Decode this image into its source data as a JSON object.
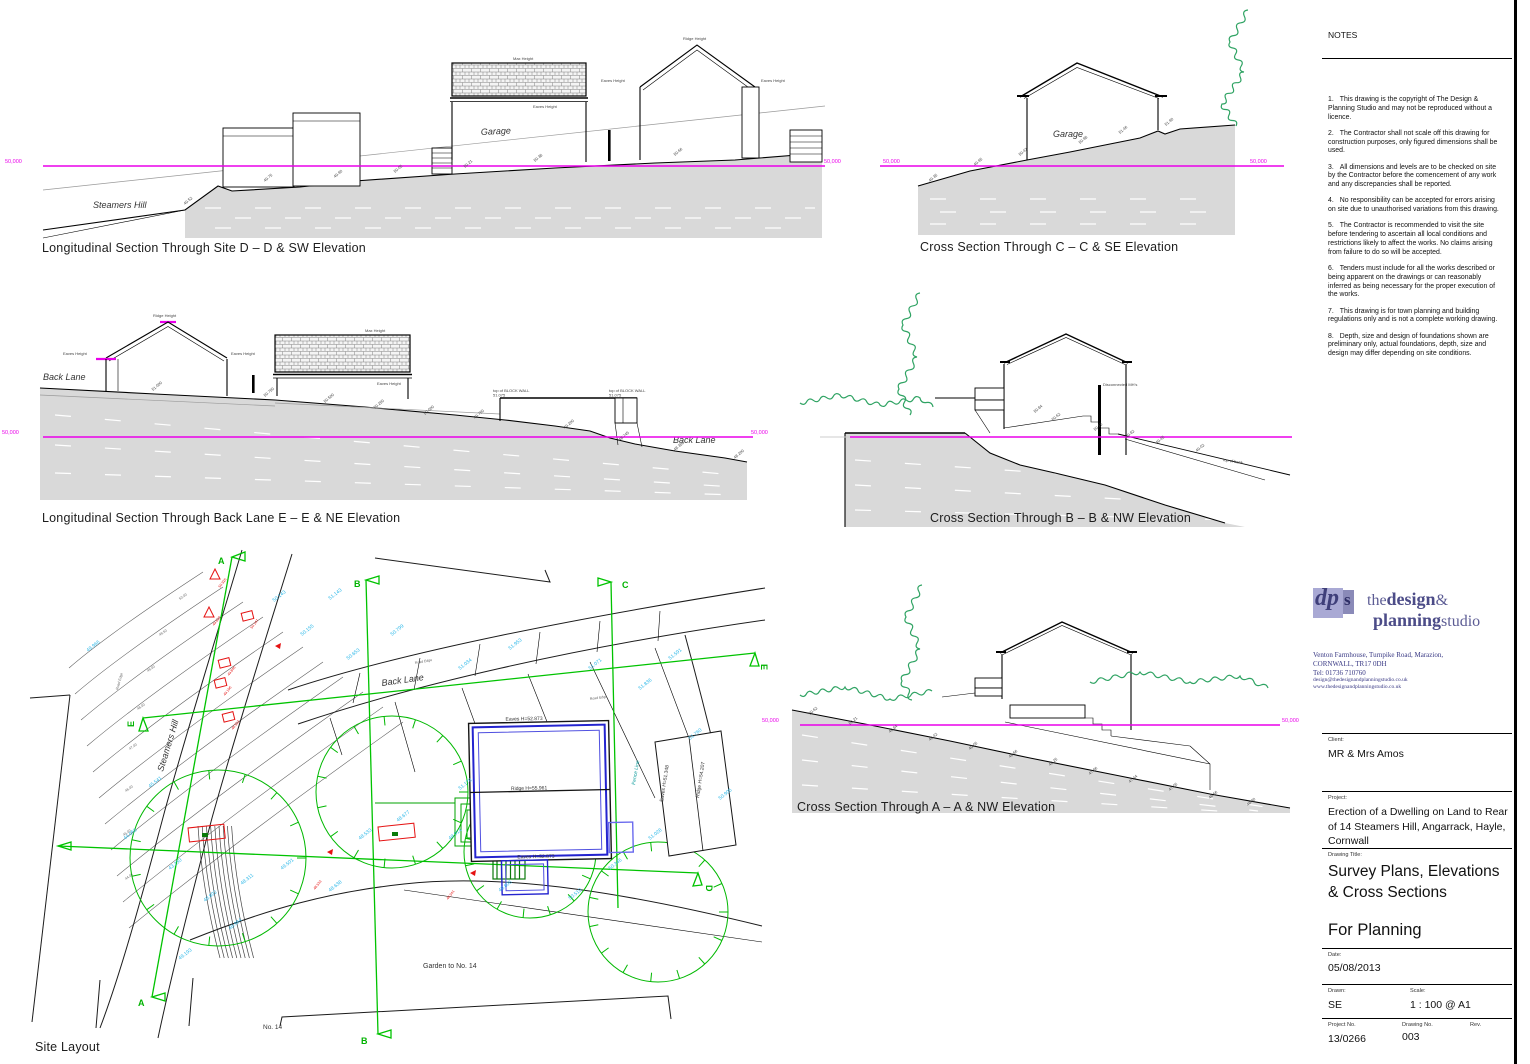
{
  "generic": {
    "ridge": "Ridge Height",
    "eaves": "Eaves Height",
    "max": "Max Height"
  },
  "sections": {
    "dd": {
      "caption": "Longitudinal Section Through Site D – D & SW Elevation",
      "road": "Steamers Hill",
      "garage": "Garage",
      "datum_left": "50,000",
      "datum_right": "50,000",
      "levels": [
        {
          "x": 150,
          "y": 193,
          "v": "49.52"
        },
        {
          "x": 230,
          "y": 170,
          "v": "49.75"
        },
        {
          "x": 300,
          "y": 166,
          "v": "49.90"
        },
        {
          "x": 360,
          "y": 161,
          "v": "50.05"
        },
        {
          "x": 430,
          "y": 156,
          "v": "50.21"
        },
        {
          "x": 500,
          "y": 150,
          "v": "50.38"
        },
        {
          "x": 640,
          "y": 144,
          "v": "50.66"
        }
      ]
    },
    "cc": {
      "caption": "Cross Section Through C – C & SE Elevation",
      "garage": "Garage",
      "datum_left": "50,000",
      "datum_right": "50,000",
      "levels": [
        {
          "x": 60,
          "y": 168,
          "v": "49.35"
        },
        {
          "x": 105,
          "y": 152,
          "v": "49.95"
        },
        {
          "x": 150,
          "y": 142,
          "v": "50.42"
        },
        {
          "x": 210,
          "y": 130,
          "v": "50.98"
        },
        {
          "x": 250,
          "y": 120,
          "v": "51.46"
        },
        {
          "x": 296,
          "y": 112,
          "v": "51.90"
        }
      ]
    },
    "ee": {
      "caption": "Longitudinal Section Through Back Lane E – E & NE Elevation",
      "road_left": "Back Lane",
      "road_right": "Back Lane",
      "datum_left": "50,000",
      "datum_right": "50,000",
      "blockwall": "top of BLOCK WALL",
      "blockwall_level": "51.075",
      "levels": [
        {
          "x": 118,
          "y": 96,
          "v": "51.000"
        },
        {
          "x": 230,
          "y": 102,
          "v": "50.750"
        },
        {
          "x": 290,
          "y": 108,
          "v": "50.500"
        },
        {
          "x": 340,
          "y": 114,
          "v": "50.250"
        },
        {
          "x": 390,
          "y": 120,
          "v": "50.000"
        },
        {
          "x": 440,
          "y": 124,
          "v": "49.750"
        },
        {
          "x": 530,
          "y": 134,
          "v": "49.200"
        },
        {
          "x": 585,
          "y": 146,
          "v": "48.745"
        },
        {
          "x": 640,
          "y": 156,
          "v": "48.350"
        },
        {
          "x": 700,
          "y": 164,
          "v": "48.200"
        }
      ]
    },
    "bb": {
      "caption": "Cross Section Through B – B & NW Elevation",
      "mh": "Disconnected MH's",
      "bank": "top of bank",
      "levels": [
        {
          "x": 240,
          "y": 128,
          "v": "50.84"
        },
        {
          "x": 258,
          "y": 136,
          "v": "50.62"
        },
        {
          "x": 300,
          "y": 146,
          "v": "50.15"
        },
        {
          "x": 332,
          "y": 153,
          "v": "49.82"
        },
        {
          "x": 362,
          "y": 159,
          "v": "49.45"
        },
        {
          "x": 402,
          "y": 167,
          "v": "49.02"
        }
      ]
    },
    "aa": {
      "caption": "Cross Section Through A – A & NW Elevation",
      "datum_left": "50,000",
      "datum_right": "50,000",
      "levels": [
        {
          "x": 52,
          "y": 140,
          "v": "50.62"
        },
        {
          "x": 92,
          "y": 150,
          "v": "50.21"
        },
        {
          "x": 132,
          "y": 158,
          "v": "49.84"
        },
        {
          "x": 172,
          "y": 166,
          "v": "49.42"
        },
        {
          "x": 212,
          "y": 175,
          "v": "49.05"
        },
        {
          "x": 252,
          "y": 183,
          "v": "48.66"
        },
        {
          "x": 292,
          "y": 191,
          "v": "48.25"
        },
        {
          "x": 332,
          "y": 200,
          "v": "47.86"
        },
        {
          "x": 372,
          "y": 208,
          "v": "47.44"
        },
        {
          "x": 412,
          "y": 216,
          "v": "47.05"
        },
        {
          "x": 452,
          "y": 224,
          "v": "46.66"
        },
        {
          "x": 490,
          "y": 231,
          "v": "46.30"
        }
      ]
    }
  },
  "site": {
    "caption": "Site Layout",
    "labels": {
      "steamers_hill": "Steamers Hill",
      "back_lane": "Back Lane",
      "garden": "Garden to No. 14",
      "no14": "No. 14",
      "fence": "Fence Line",
      "road_edge": "Road Edge"
    },
    "building": {
      "eaves_top": "Eaves H=52.873",
      "ridge": "Ridge H=55.961",
      "eaves_bottom": "Eaves H=52.873"
    },
    "building2": {
      "eaves": "Eaves H=51.348",
      "ridge": "Ridge H=54.207"
    },
    "markers": {
      "a": "A",
      "b": "B",
      "c": "C",
      "d": "D",
      "e": "E"
    },
    "contour_labels": [
      {
        "x": 150,
        "y": 60,
        "v": "50.00"
      },
      {
        "x": 130,
        "y": 96,
        "v": "49.50"
      },
      {
        "x": 118,
        "y": 132,
        "v": "49.00"
      },
      {
        "x": 108,
        "y": 170,
        "v": "48.00"
      },
      {
        "x": 100,
        "y": 210,
        "v": "47.00"
      },
      {
        "x": 96,
        "y": 252,
        "v": "46.00"
      },
      {
        "x": 94,
        "y": 296,
        "v": "45.00"
      },
      {
        "x": 96,
        "y": 340,
        "v": "44.00"
      }
    ],
    "spot_levels": [
      {
        "x": 244,
        "y": 62,
        "v": "50.143"
      },
      {
        "x": 272,
        "y": 96,
        "v": "50.155"
      },
      {
        "x": 318,
        "y": 120,
        "v": "50.653"
      },
      {
        "x": 362,
        "y": 96,
        "v": "50.799"
      },
      {
        "x": 300,
        "y": 60,
        "v": "51.143"
      },
      {
        "x": 58,
        "y": 112,
        "v": "49.966"
      },
      {
        "x": 120,
        "y": 248,
        "v": "45.541"
      },
      {
        "x": 95,
        "y": 300,
        "v": "44.056"
      },
      {
        "x": 140,
        "y": 330,
        "v": "43.250"
      },
      {
        "x": 175,
        "y": 362,
        "v": "48.802"
      },
      {
        "x": 212,
        "y": 345,
        "v": "48.311"
      },
      {
        "x": 252,
        "y": 330,
        "v": "49.501"
      },
      {
        "x": 300,
        "y": 352,
        "v": "48.638"
      },
      {
        "x": 330,
        "y": 300,
        "v": "48.533"
      },
      {
        "x": 368,
        "y": 282,
        "v": "48.677"
      },
      {
        "x": 420,
        "y": 300,
        "v": "48.914"
      },
      {
        "x": 470,
        "y": 352,
        "v": "49.806"
      },
      {
        "x": 540,
        "y": 360,
        "v": "50.510"
      },
      {
        "x": 580,
        "y": 330,
        "v": "50.346"
      },
      {
        "x": 620,
        "y": 300,
        "v": "51.028"
      },
      {
        "x": 640,
        "y": 120,
        "v": "51.591"
      },
      {
        "x": 610,
        "y": 150,
        "v": "51.836"
      },
      {
        "x": 560,
        "y": 130,
        "v": "51.071"
      },
      {
        "x": 480,
        "y": 110,
        "v": "51.953"
      },
      {
        "x": 430,
        "y": 130,
        "v": "51.034"
      },
      {
        "x": 660,
        "y": 200,
        "v": "51.760"
      },
      {
        "x": 690,
        "y": 260,
        "v": "50.905"
      },
      {
        "x": 150,
        "y": 420,
        "v": "49.193"
      },
      {
        "x": 200,
        "y": 390,
        "v": "48.984"
      },
      {
        "x": 430,
        "y": 250,
        "v": "51.178"
      }
    ],
    "red_markers": [
      {
        "x": 185,
        "y": 35,
        "t": "tri",
        "v": "50.925"
      },
      {
        "x": 179,
        "y": 73,
        "t": "tri",
        "v": "49.620"
      },
      {
        "x": 217,
        "y": 76,
        "t": "rect",
        "v": "50.147"
      },
      {
        "x": 194,
        "y": 123,
        "t": "rect",
        "v": "49.846"
      },
      {
        "x": 190,
        "y": 143,
        "t": "rect",
        "v": "49.196"
      },
      {
        "x": 198,
        "y": 177,
        "t": "rect",
        "v": "48.922"
      },
      {
        "x": 245,
        "y": 106,
        "t": "arrow"
      },
      {
        "x": 297,
        "y": 312,
        "t": "arrow"
      },
      {
        "x": 440,
        "y": 333,
        "t": "arrow"
      },
      {
        "x": 158,
        "y": 288,
        "t": "rrect"
      },
      {
        "x": 348,
        "y": 287,
        "t": "rrect"
      },
      {
        "x": 280,
        "y": 337,
        "t": "txt",
        "v": "48.533"
      },
      {
        "x": 413,
        "y": 347,
        "t": "txt",
        "v": "48.341"
      }
    ]
  },
  "titleblock": {
    "notes_title": "NOTES",
    "notes": [
      {
        "n": "1.",
        "t": "This drawing is the copyright of The Design & Planning Studio and may not be reproduced without a licence."
      },
      {
        "n": "2.",
        "t": "The Contractor shall not scale off this drawing for construction purposes, only figured dimensions shall be used."
      },
      {
        "n": "3.",
        "t": "All dimensions and levels are to be checked on site by the Contractor before the comencement of any work and any discrepancies shall be reported."
      },
      {
        "n": "4.",
        "t": "No responsibility can be accepted for errors arising on site due to unauthorised variations from this drawing."
      },
      {
        "n": "5.",
        "t": "The Contractor is recommended to visit the site before tendering to ascertain all local conditions and restrictions likely to affect the works.  No claims arising from failure to do so will be accepted."
      },
      {
        "n": "6.",
        "t": "Tenders must include for all the works described or being apparent on the drawings or can reasonably inferred as being necessary for the proper execution of the works."
      },
      {
        "n": "7.",
        "t": "This drawing is for town planning and building regulations only and is not a complete working drawing."
      },
      {
        "n": "8.",
        "t": "Depth, size and design of foundations shown are preliminary only, actual foundations, depth, size and design may differ depending on site conditions."
      }
    ],
    "logo": {
      "dp": "dp",
      "s": "s",
      "the": "the",
      "design": "design",
      "amp": "&",
      "planning": "planning",
      "studio": "studio"
    },
    "address": [
      "Venton Farmhouse, Turnpike Road, Marazion,",
      "CORNWALL, TR17 0DH",
      "Tel: 01736 710760",
      "design@thedesignandplanningstudio.co.uk",
      "www.thedesignandplanningstudio.co.uk"
    ],
    "client_label": "Client:",
    "client": "MR & Mrs Amos",
    "project_label": "Project:",
    "project": "Erection of a Dwelling on Land to Rear of 14 Steamers Hill, Angarrack, Hayle, Cornwall",
    "drawing_title_label": "Drawing Title:",
    "drawing_title": "Survey Plans, Elevations & Cross Sections",
    "status": "For Planning",
    "date_label": "Date:",
    "date": "05/08/2013",
    "drawn_label": "Drawn:",
    "drawn": "SE",
    "scale_label": "Scale:",
    "scale": "1 : 100 @ A1",
    "project_no_label": "Project No.",
    "project_no": "13/0266",
    "drawing_no_label": "Drawing No.",
    "drawing_no": "003",
    "rev_label": "Rev.",
    "rev": ""
  },
  "colors": {
    "magenta": "#ea00ea",
    "site_green": "#00c300",
    "tree_green": "#2fa363",
    "cyan": "#2fb9e9",
    "red": "#e51212",
    "ground": "#d9d9d9",
    "blue": "#2424cf"
  }
}
